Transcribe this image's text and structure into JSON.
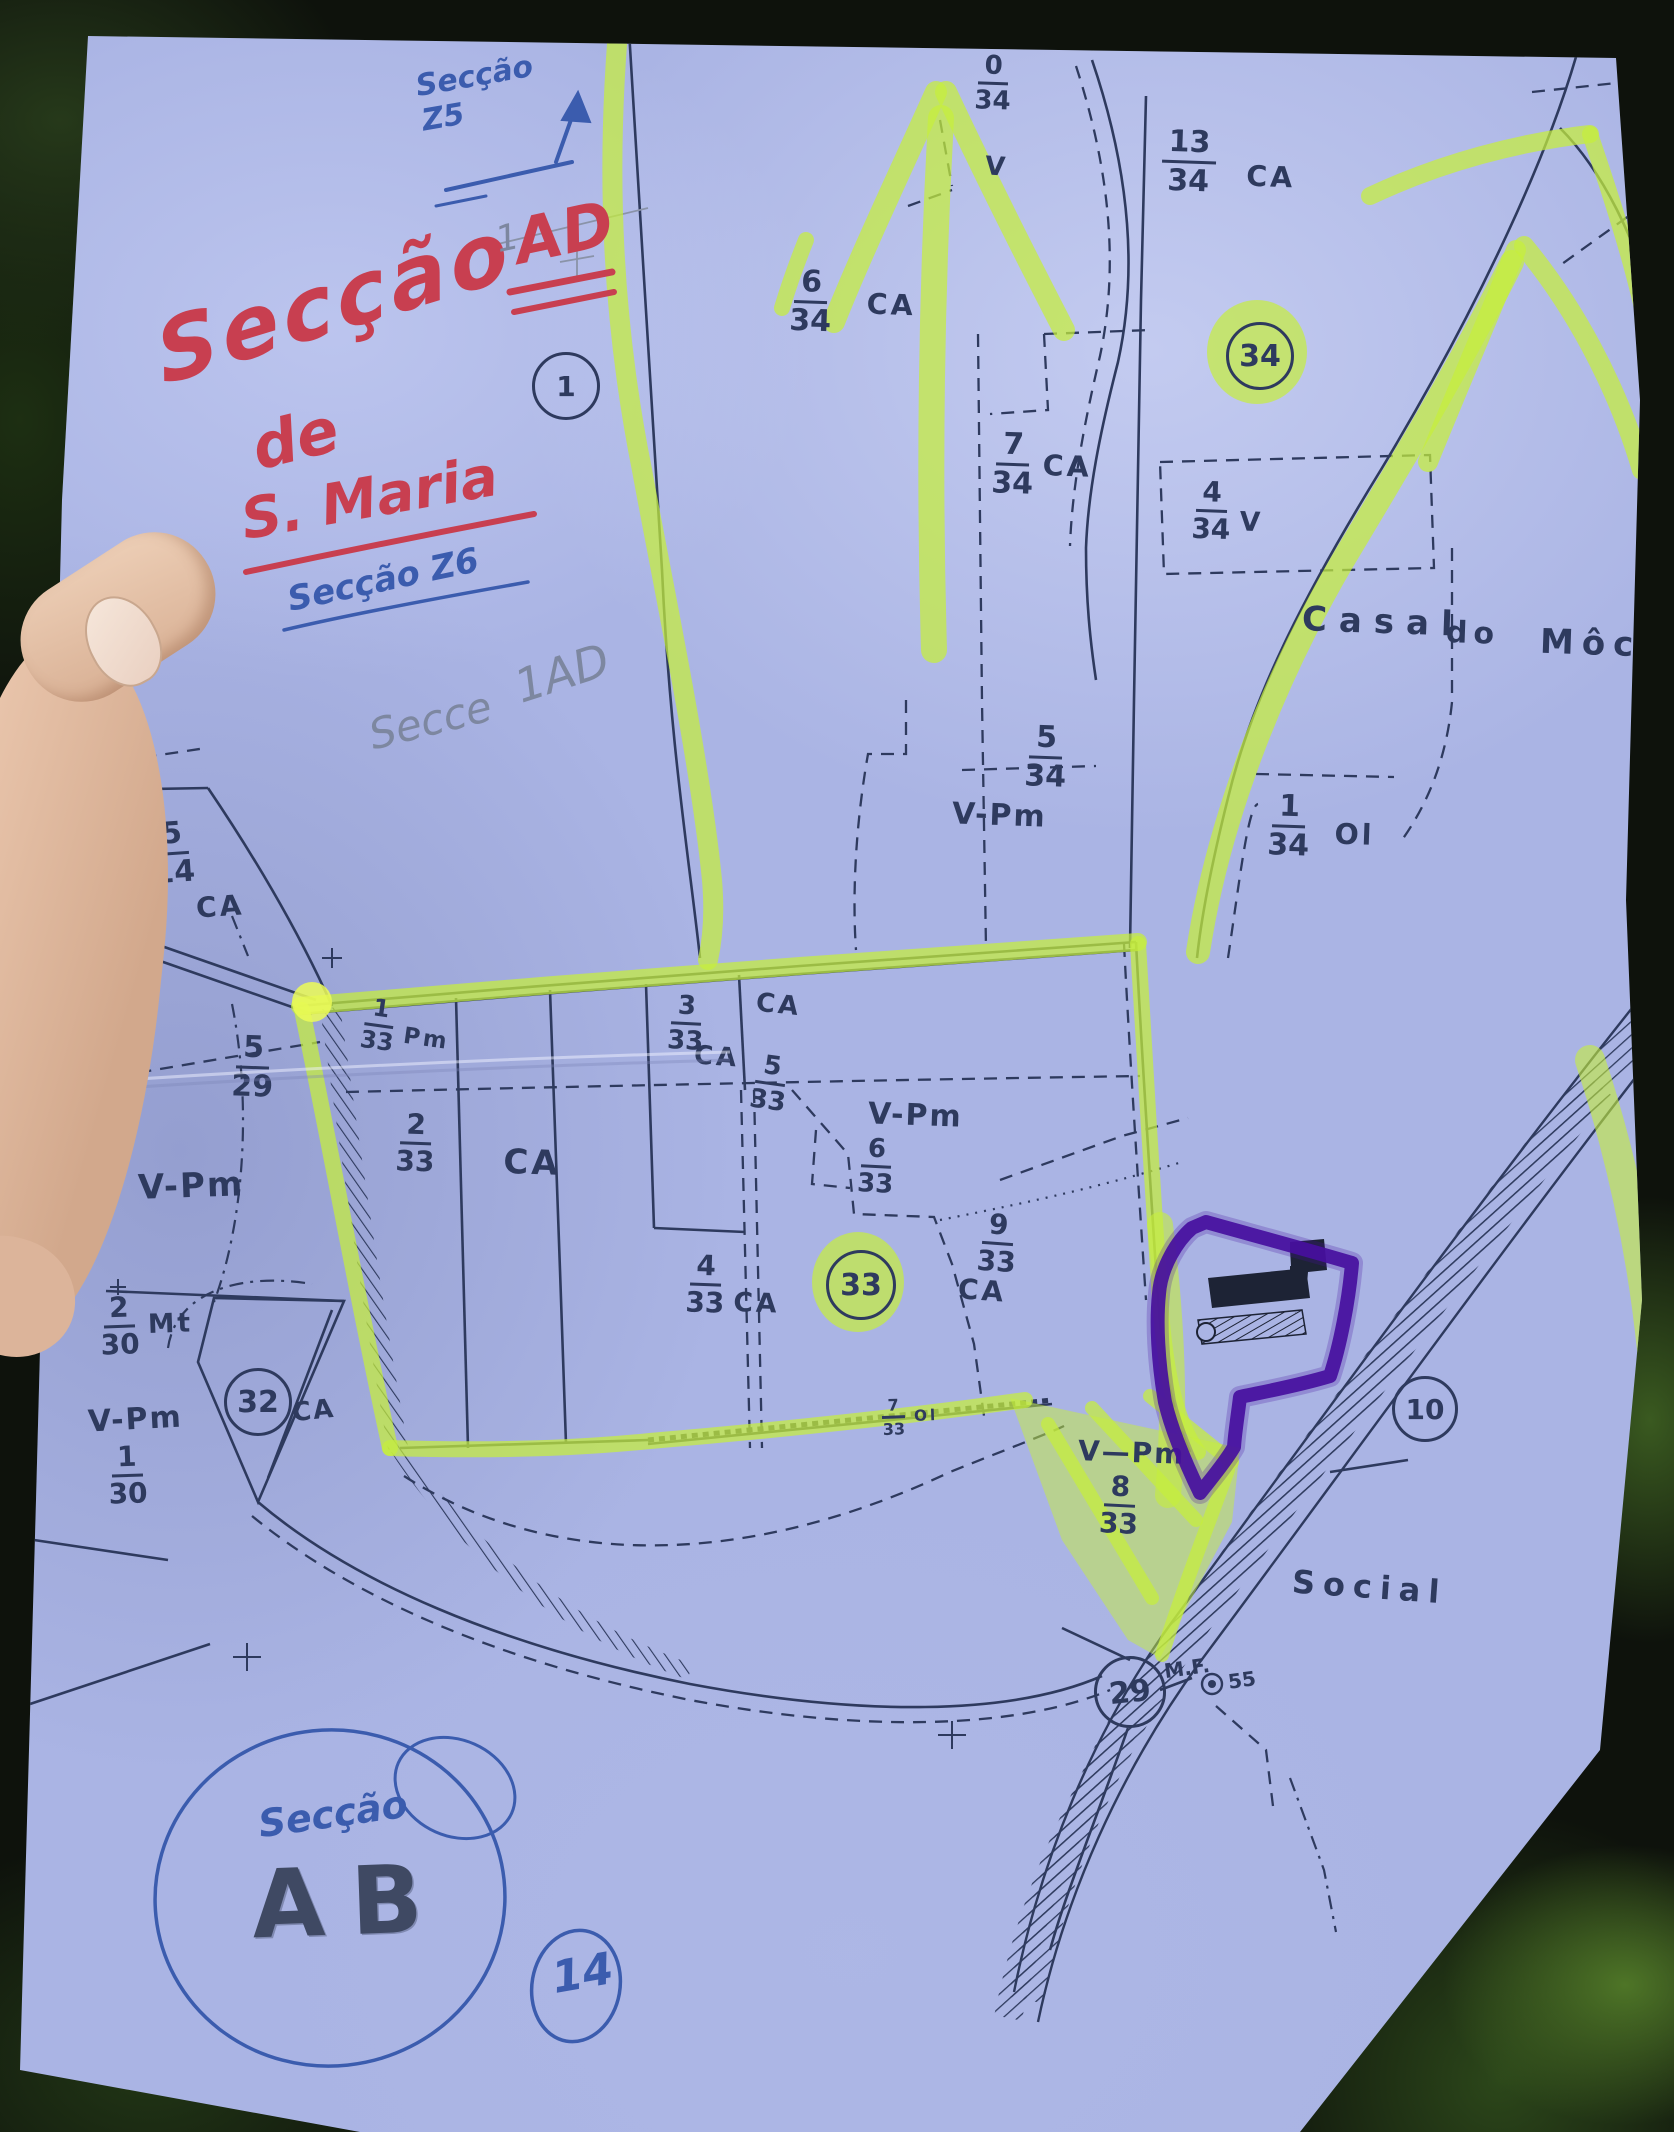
{
  "document_type": "cadastral-section-map-photo",
  "colors": {
    "paper": "#aab4e4",
    "ink": "#2e3a5e",
    "red_pen": "#c83f50",
    "blue_pen": "#3b5cae",
    "pencil": "#7d87a0",
    "highlighter": "#c6ee3c",
    "purple_marker": "#470f9e",
    "skin": "#ddb69c"
  },
  "notes": {
    "red_title": "Secção",
    "red_sup": "AD",
    "red_de": "de",
    "red_smaria": "S. Maria",
    "blue_z5": "Secção Z5",
    "blue_z6": "Secção Z6",
    "pencil_secce": "Secce",
    "pencil_1ad": "1AD",
    "pencil_1": "1",
    "circle_secao": "Secção",
    "ab": "AB"
  },
  "circles": {
    "one": "1",
    "n34": "34",
    "n33": "33",
    "n32": "32",
    "n10": "10",
    "n29": "29",
    "n14": "14"
  },
  "parcels": [
    {
      "num": "0",
      "den": "34",
      "code": ""
    },
    {
      "num": "13",
      "den": "34",
      "code": "CA"
    },
    {
      "num": "6",
      "den": "34",
      "code": "CA"
    },
    {
      "num": "7",
      "den": "34",
      "code": "CA"
    },
    {
      "num": "4",
      "den": "34",
      "code": "V"
    },
    {
      "num": "5",
      "den": "34",
      "code": ""
    },
    {
      "num": "1",
      "den": "34",
      "code": "Ol"
    },
    {
      "num": "5",
      "den": "14",
      "code": ""
    },
    {
      "num": "5",
      "den": "29",
      "code": ""
    },
    {
      "num": "1",
      "den": "33",
      "code": "Pm"
    },
    {
      "num": "3",
      "den": "33",
      "code": ""
    },
    {
      "num": "5",
      "den": "33",
      "code": ""
    },
    {
      "num": "2",
      "den": "33",
      "code": "CA"
    },
    {
      "num": "6",
      "den": "33",
      "code": ""
    },
    {
      "num": "9",
      "den": "33",
      "code": ""
    },
    {
      "num": "4",
      "den": "33",
      "code": "CA"
    },
    {
      "num": "2",
      "den": "30",
      "code": "Mt"
    },
    {
      "num": "1",
      "den": "30",
      "code": ""
    },
    {
      "num": "7",
      "den": "33",
      "code": "Ol"
    },
    {
      "num": "8",
      "den": "33",
      "code": ""
    }
  ],
  "texts": {
    "v_top": "V",
    "ca_514": "CA",
    "ca_3a": "CA",
    "ca_3b": "CA",
    "vpm_534": "V-Pm",
    "vpm_633": "V-Pm",
    "ca_933": "CA",
    "vpm_left": "V-Pm",
    "vpm_bl": "V-Pm",
    "ca_32": "CA",
    "vpm_b": "V—Pm",
    "casal": "Casal",
    "do_": "do",
    "mocho": "Môch",
    "social": "Social",
    "mf": "M.F.",
    "mf_num": "55"
  }
}
